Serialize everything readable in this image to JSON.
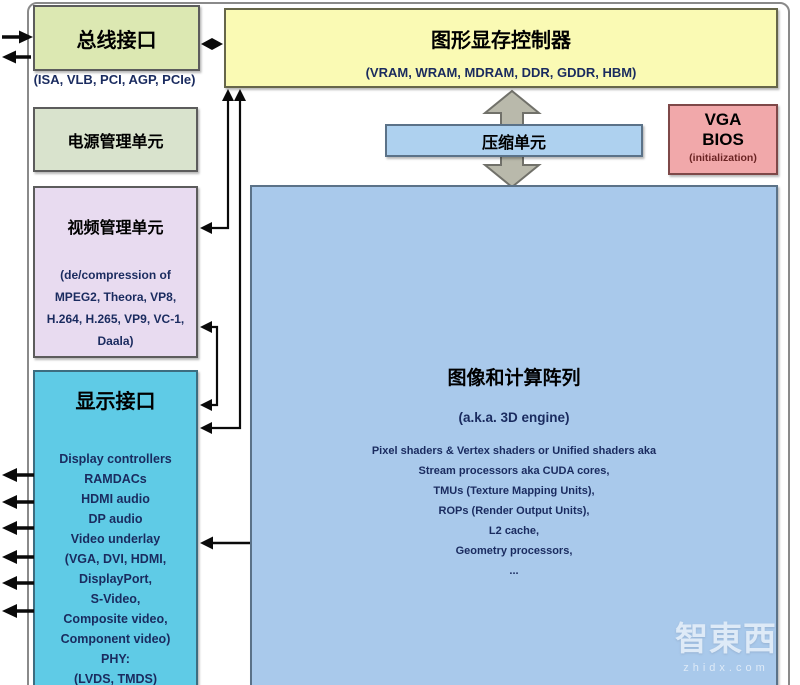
{
  "diagram": {
    "bus_interface": {
      "title": "总线接口",
      "subtitle": "(ISA, VLB, PCI, AGP, PCIe)"
    },
    "gmc": {
      "title": "图形显存控制器",
      "subtitle": "(VRAM, WRAM, MDRAM, DDR, GDDR, HBM)"
    },
    "power_unit": {
      "title": "电源管理单元"
    },
    "video_unit": {
      "title": "视频管理单元",
      "lines": [
        "(de/compression of",
        "MPEG2, Theora, VP8,",
        "H.264, H.265, VP9, VC-1,",
        "Daala)"
      ]
    },
    "display_interface": {
      "title": "显示接口",
      "lines": [
        "Display controllers",
        "RAMDACs",
        "HDMI audio",
        "DP audio",
        "Video underlay",
        "(VGA, DVI, HDMI,",
        "DisplayPort,",
        "S-Video,",
        "Composite video,",
        "Component video)",
        "PHY:",
        "(LVDS, TMDS)"
      ]
    },
    "compression_unit": {
      "title": "压缩单元"
    },
    "vga_bios": {
      "line1": "VGA",
      "line2": "BIOS",
      "line3": "(initialization)"
    },
    "compute_array": {
      "title": "图像和计算阵列",
      "subtitle": "(a.k.a. 3D engine)",
      "lines": [
        "Pixel shaders & Vertex shaders or Unified shaders aka",
        "Stream processors aka CUDA cores,",
        "TMUs (Texture Mapping Units),",
        "ROPs (Render Output Units),",
        "L2 cache,",
        "Geometry processors,",
        "..."
      ]
    },
    "watermark": {
      "logo": "智東西",
      "url": "zhidx.com"
    }
  },
  "colors": {
    "bus_fill": "#dce8b2",
    "gmc_fill": "#fafab4",
    "power_fill": "#d9e3cd",
    "video_fill": "#e8dbf0",
    "display_fill": "#5fcbe6",
    "blue_fill": "#a9c9eb",
    "vga_fill": "#f1a8aa",
    "navy_text": "#1a2b5f",
    "arrow_black": "#0a0a0a",
    "big_arrow_gray": "#b9b9ab"
  }
}
